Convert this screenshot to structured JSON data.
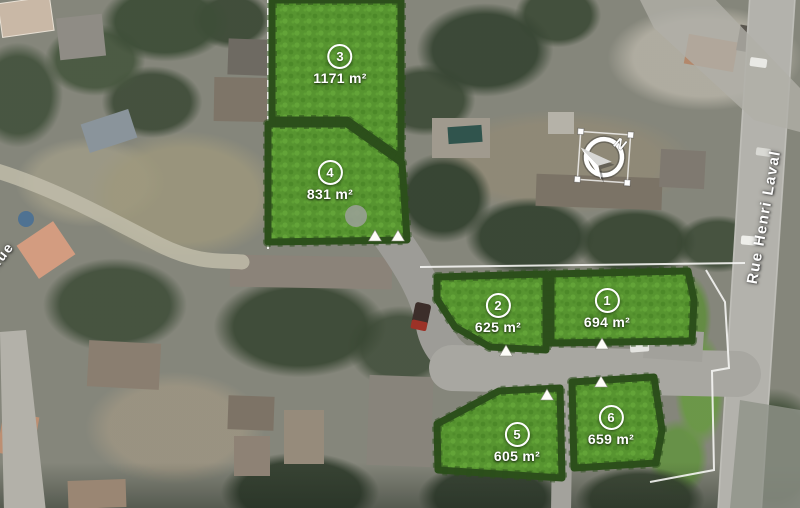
{
  "map": {
    "lots": [
      {
        "number": "1",
        "area": "694 m²"
      },
      {
        "number": "2",
        "area": "625 m²"
      },
      {
        "number": "3",
        "area": "1171 m²"
      },
      {
        "number": "4",
        "area": "831 m²"
      },
      {
        "number": "5",
        "area": "605 m²"
      },
      {
        "number": "6",
        "area": "659 m²"
      }
    ],
    "streets": [
      {
        "name": "Rue Henri Laval"
      },
      {
        "name": "Rue"
      }
    ],
    "compass": {
      "north_label": "N"
    },
    "colors": {
      "parcel_green": "#58992f",
      "hedge_green": "#2c4f1b",
      "road_gray": "#a8a7a1",
      "label_white": "#ffffff"
    }
  }
}
